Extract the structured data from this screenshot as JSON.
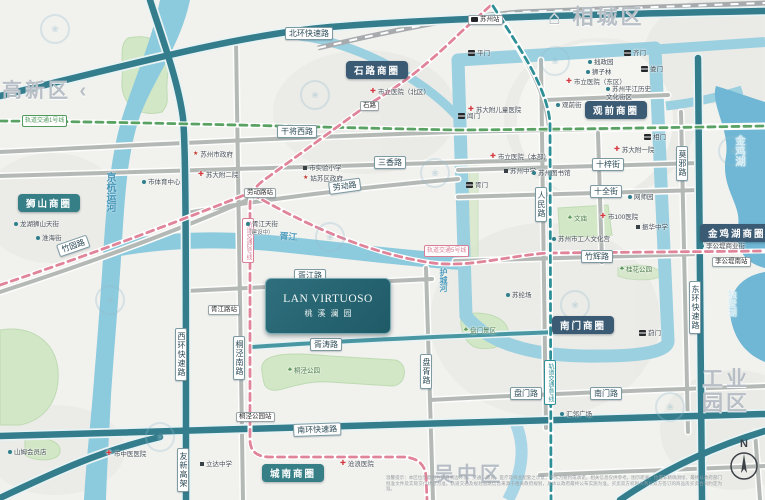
{
  "project": {
    "name_en": "LAN VIRTUOSO",
    "name_cn": "桃溪澜园"
  },
  "compass_label": "N",
  "disclaimer": "温馨提示：本区位示意图为项目周边环境、交通、教育、医疗及商业配套之示意，不作为要约或承诺，相关信息仅供参考。图示距离、位置非精确测绘，最终以政府部门批准文件及实际交付状态为准。轨道交通及规划道路信息来源于相关政府规划，具体以政府最终公布实施为准。买卖双方权利义务以双方签订的商品房买卖合同约定为准。",
  "colors": {
    "expressway": "#337d8d",
    "road_gray": "#b4b9b6",
    "water": "#8ccadd",
    "park": "#d2e7c6",
    "metro_line_1": "#5aa263",
    "metro_line_2": "#e0849a",
    "metro_line_4": "#2f8f96",
    "badge_dark": "#3b5a73",
    "badge_teal": "#377f86",
    "project_bg": "#2f6f7d"
  },
  "districts": [
    {
      "t": "高新区 ‹",
      "x": 2,
      "y": 80,
      "size": 20
    },
    {
      "t": "⌂ 相城区",
      "x": 548,
      "y": 6,
      "size": 21
    },
    {
      "t": "工业\n园区",
      "x": 702,
      "y": 368,
      "size": 21
    },
    {
      "t": "吴中区",
      "x": 434,
      "y": 464,
      "size": 20
    }
  ],
  "waters": [
    {
      "t": "京杭运河",
      "x": 102,
      "y": 172,
      "dir": "v",
      "size": 10,
      "c": "#4796b8"
    },
    {
      "t": "护城河",
      "x": 438,
      "y": 268,
      "dir": "v",
      "size": 8,
      "c": "#4e9dbd"
    },
    {
      "t": "金鸡湖",
      "x": 733,
      "y": 135,
      "dir": "v",
      "size": 10.5,
      "c": "#d8eef5"
    },
    {
      "t": "独墅湖",
      "x": 726,
      "y": 290,
      "dir": "v",
      "size": 9,
      "c": "#d8eef5"
    },
    {
      "t": "胥江",
      "x": 280,
      "y": 229,
      "size": 9,
      "rot": 4,
      "c": "#4e9dbd"
    }
  ],
  "badges": [
    {
      "t": "石路商圈",
      "x": 346,
      "y": 61,
      "bg": "#3b5a73"
    },
    {
      "t": "观前商圈",
      "x": 585,
      "y": 101,
      "bg": "#3b5a73"
    },
    {
      "t": "狮山商圈",
      "x": 18,
      "y": 194,
      "bg": "#377f86"
    },
    {
      "t": "金鸡湖商圈",
      "x": 700,
      "y": 224,
      "bg": "#3b5a73"
    },
    {
      "t": "南门商圈",
      "x": 552,
      "y": 316,
      "bg": "#3b5a73"
    },
    {
      "t": "城南商圈",
      "x": 262,
      "y": 464,
      "bg": "#377f86"
    }
  ],
  "road_labels": [
    {
      "t": "北环快速路",
      "x": 285,
      "y": 27
    },
    {
      "t": "干将西路",
      "x": 277,
      "y": 125
    },
    {
      "t": "三香路",
      "x": 374,
      "y": 156
    },
    {
      "t": "劳动路",
      "x": 328,
      "y": 182,
      "rot": -8
    },
    {
      "t": "胥江路",
      "x": 294,
      "y": 269
    },
    {
      "t": "胥涛路",
      "x": 310,
      "y": 338
    },
    {
      "t": "南环快速路",
      "x": 293,
      "y": 424,
      "rot": -2
    },
    {
      "t": "十梓街",
      "x": 592,
      "y": 158
    },
    {
      "t": "十全街",
      "x": 590,
      "y": 185
    },
    {
      "t": "竹辉路",
      "x": 581,
      "y": 250
    },
    {
      "t": "盘门路",
      "x": 510,
      "y": 387
    },
    {
      "t": "南门路",
      "x": 590,
      "y": 387
    },
    {
      "t": "竹园路",
      "x": 56,
      "y": 245,
      "rot": -19
    },
    {
      "t": "西环快速路",
      "x": 175,
      "y": 328,
      "dir": "v"
    },
    {
      "t": "友新高架",
      "x": 177,
      "y": 448,
      "dir": "v"
    },
    {
      "t": "桐泾南路",
      "x": 233,
      "y": 336,
      "dir": "v"
    },
    {
      "t": "盘胥路",
      "x": 420,
      "y": 354,
      "dir": "v"
    },
    {
      "t": "人民路",
      "x": 535,
      "y": 187,
      "dir": "v"
    },
    {
      "t": "莫邪路",
      "x": 676,
      "y": 146,
      "dir": "v"
    },
    {
      "t": "东环快速路",
      "x": 689,
      "y": 281,
      "dir": "v"
    }
  ],
  "metro_labels": [
    {
      "t": "轨道交通1号线",
      "x": 22,
      "y": 115,
      "c": "#4f9a5c"
    },
    {
      "t": "轨道交通2号线",
      "x": 242,
      "y": 218,
      "dir": "v",
      "c": "#d87f97"
    },
    {
      "t": "轨道交通4号线",
      "x": 544,
      "y": 360,
      "dir": "v",
      "c": "#2f8f96"
    },
    {
      "t": "轨道交通5号线",
      "x": 424,
      "y": 245,
      "c": "#d87f97"
    }
  ],
  "stations": [
    {
      "t": "苏州站",
      "x": 468,
      "y": 15,
      "icon": "rail"
    },
    {
      "t": "石路",
      "x": 360,
      "y": 101
    },
    {
      "t": "劳动路站",
      "x": 244,
      "y": 188
    },
    {
      "t": "胥江路站",
      "x": 208,
      "y": 305
    },
    {
      "t": "桐泾公园站",
      "x": 236,
      "y": 412
    },
    {
      "t": "李公堤南站",
      "x": 712,
      "y": 257
    }
  ],
  "pois": [
    {
      "t": "市立医院（北区）",
      "x": 370,
      "y": 88,
      "type": "hospital"
    },
    {
      "t": "苏大附儿童医院",
      "x": 468,
      "y": 106,
      "type": "hospital"
    },
    {
      "t": "市立医院（东区）",
      "x": 566,
      "y": 78,
      "type": "hospital"
    },
    {
      "t": "苏大附一院",
      "x": 614,
      "y": 146,
      "type": "hospital"
    },
    {
      "t": "市立医院（本部）",
      "x": 490,
      "y": 153,
      "type": "hospital"
    },
    {
      "t": "市100医院",
      "x": 600,
      "y": 213,
      "type": "hospital"
    },
    {
      "t": "苏大附二院",
      "x": 198,
      "y": 171,
      "type": "hospital"
    },
    {
      "t": "市中医医院",
      "x": 106,
      "y": 450,
      "type": "hospital"
    },
    {
      "t": "沧浪医院",
      "x": 340,
      "y": 460,
      "type": "hospital"
    },
    {
      "t": "平门",
      "x": 468,
      "y": 50,
      "type": "gate"
    },
    {
      "t": "阊门",
      "x": 458,
      "y": 113,
      "type": "gate"
    },
    {
      "t": "齐门",
      "x": 624,
      "y": 50,
      "type": "gate"
    },
    {
      "t": "娄门",
      "x": 641,
      "y": 66,
      "type": "gate"
    },
    {
      "t": "相门",
      "x": 644,
      "y": 134,
      "type": "gate"
    },
    {
      "t": "胥门",
      "x": 466,
      "y": 182,
      "type": "gate"
    },
    {
      "t": "葑门",
      "x": 639,
      "y": 330,
      "type": "gate"
    },
    {
      "t": "苏州市政府",
      "x": 193,
      "y": 151,
      "type": "gov"
    },
    {
      "t": "姑苏区政府",
      "x": 303,
      "y": 175,
      "type": "gov"
    },
    {
      "t": "市实验小学",
      "x": 303,
      "y": 165,
      "type": "school"
    },
    {
      "t": "苏州中学",
      "x": 504,
      "y": 168,
      "type": "school"
    },
    {
      "t": "振华中学",
      "x": 636,
      "y": 224,
      "type": "school"
    },
    {
      "t": "立达中学",
      "x": 200,
      "y": 461,
      "type": "school"
    },
    {
      "t": "胥江天街",
      "x": 246,
      "y": 221,
      "type": "place"
    },
    {
      "t": "（建设中）",
      "x": 246,
      "y": 230,
      "type": "sub"
    },
    {
      "t": "市体育中心",
      "x": 142,
      "y": 179,
      "type": "place"
    },
    {
      "t": "龙湖狮山天街",
      "x": 14,
      "y": 221,
      "type": "place"
    },
    {
      "t": "淮海街",
      "x": 36,
      "y": 235,
      "type": "place"
    },
    {
      "t": "拙政园",
      "x": 588,
      "y": 59,
      "type": "place"
    },
    {
      "t": "狮子林",
      "x": 586,
      "y": 69,
      "type": "place"
    },
    {
      "t": "苏州平江历史\n文化街区",
      "x": 606,
      "y": 86,
      "type": "place"
    },
    {
      "t": "观前街",
      "x": 556,
      "y": 102,
      "type": "place"
    },
    {
      "t": "苏州图书馆",
      "x": 532,
      "y": 170,
      "type": "place"
    },
    {
      "t": "网师园",
      "x": 628,
      "y": 194,
      "type": "place"
    },
    {
      "t": "苏州市工人文化宫",
      "x": 552,
      "y": 236,
      "type": "place"
    },
    {
      "t": "苏纶场",
      "x": 506,
      "y": 292,
      "type": "place"
    },
    {
      "t": "汇邻广场",
      "x": 560,
      "y": 411,
      "type": "place"
    },
    {
      "t": "李公堤商业街",
      "x": 700,
      "y": 243,
      "type": "place"
    },
    {
      "t": "山姆会员店",
      "x": 8,
      "y": 449,
      "type": "place"
    },
    {
      "t": "桐泾公园",
      "x": 288,
      "y": 367,
      "type": "park"
    },
    {
      "t": "桂花公园",
      "x": 620,
      "y": 266,
      "type": "park"
    },
    {
      "t": "盘门景区",
      "x": 464,
      "y": 327,
      "type": "park"
    },
    {
      "t": "文庙",
      "x": 568,
      "y": 215,
      "type": "park"
    }
  ]
}
